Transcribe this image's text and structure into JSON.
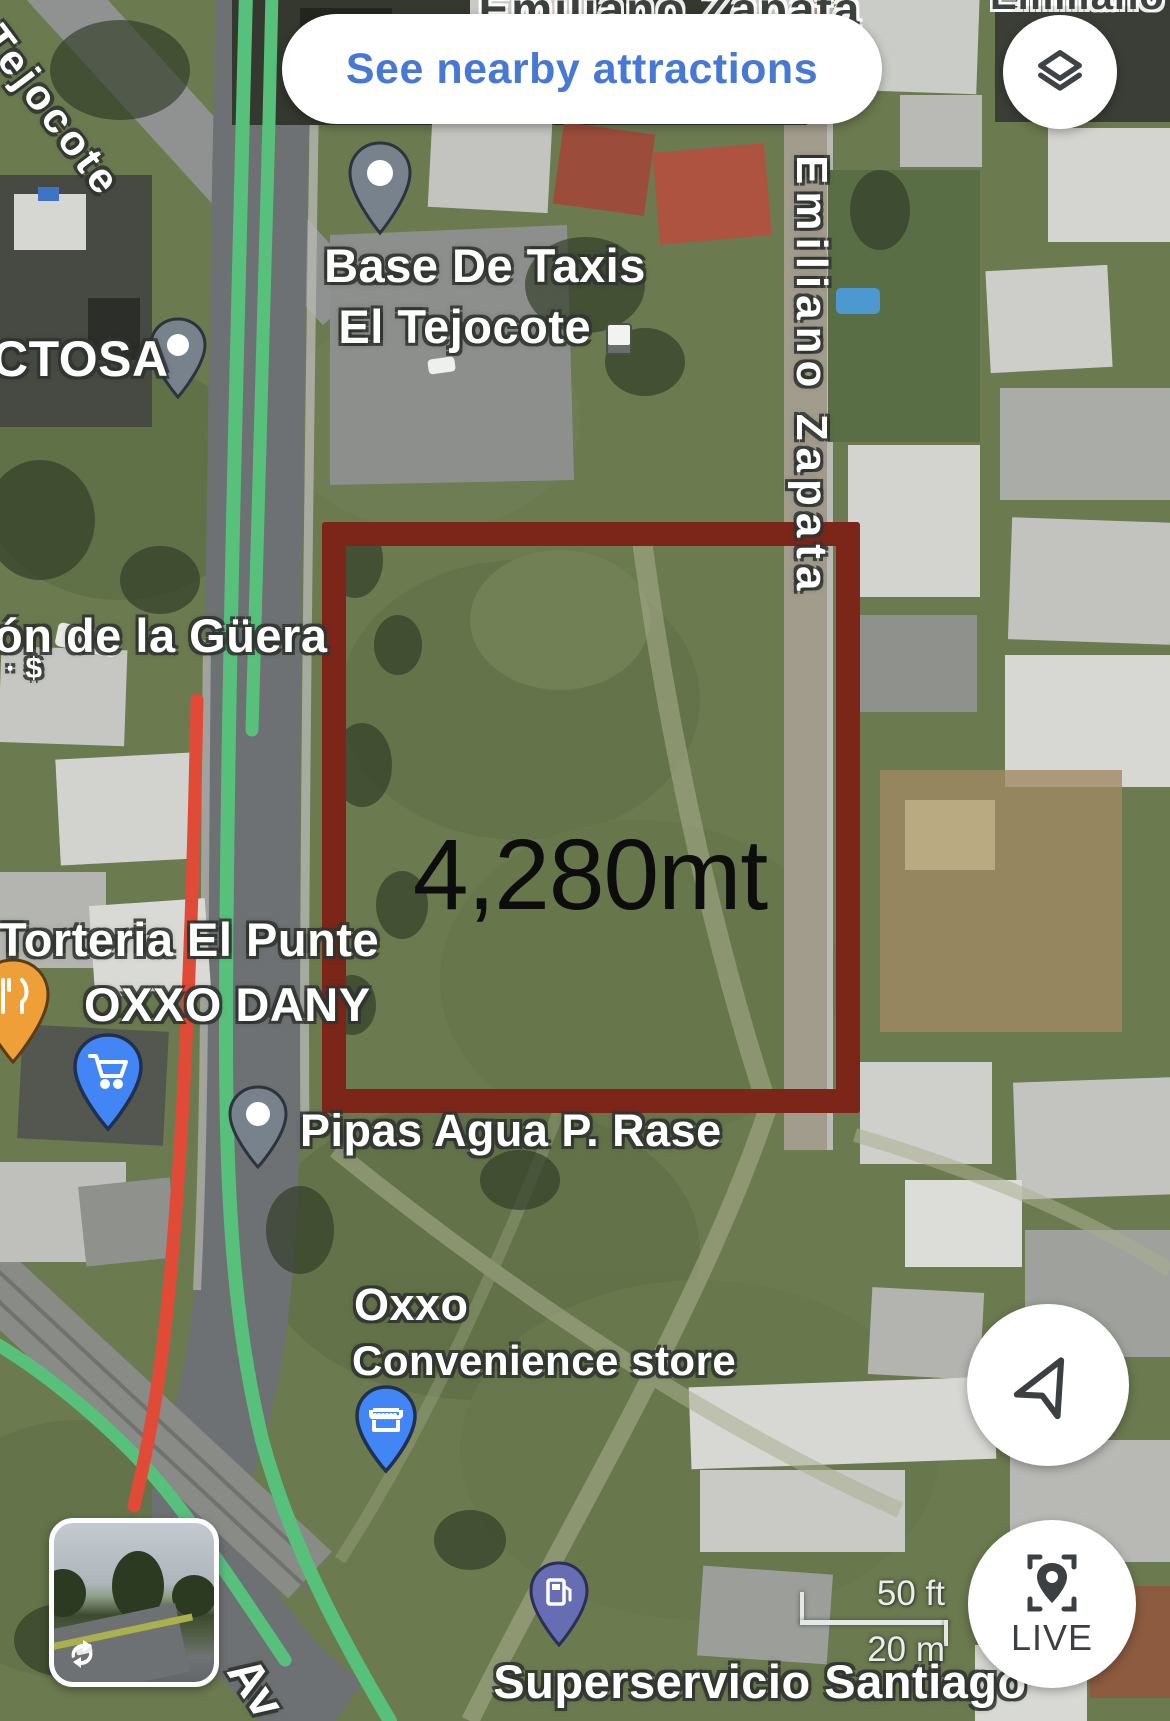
{
  "top_bar": {
    "see_nearby_label": "See nearby attractions"
  },
  "controls": {
    "live_label": "LIVE"
  },
  "map_overlay": {
    "area_label": "4,280mt",
    "plot_outline_color": "#7c2619"
  },
  "scale_bar": {
    "imperial": "50 ft",
    "metric": "20 m"
  },
  "street_labels": {
    "tejocote": "Tejocote",
    "zapata_top": "Emiliano Zapata",
    "zapata_top_right": "Emiliano Zapata",
    "zapata_right": "Emiliano Zapata",
    "avenue_partial": "Av"
  },
  "poi_labels": {
    "ctosa": "CTOSA",
    "base_taxis_line1": "Base De Taxis",
    "base_taxis_line2": "El Tejocote",
    "guera": "ón de la Güera",
    "guera_price": "· $",
    "torteria": "Torteria El Punte",
    "oxxo_dany": "OXXO DANY",
    "pipas": "Pipas Agua P. Rase",
    "oxxo": "Oxxo",
    "oxxo_type": "Convenience store",
    "superservicio": "Superservicio Santiago"
  },
  "colors": {
    "link_blue": "#4678d4",
    "route_green": "#57c17c",
    "traffic_red": "#e04b38",
    "plot_outline": "#7c2619"
  },
  "icons": {
    "layers": "stacked-diamonds",
    "navigation": "tilted-paper-plane-outline",
    "live": "map-pin-in-brackets",
    "streetview": "circular-arrows",
    "restaurant": "fork-and-knife",
    "shopping": "shopping-cart",
    "convenience": "storefront-awning",
    "fuel": "fuel-pump",
    "generic_pin": "teardrop-with-white-dot",
    "building": "small-white-square"
  }
}
